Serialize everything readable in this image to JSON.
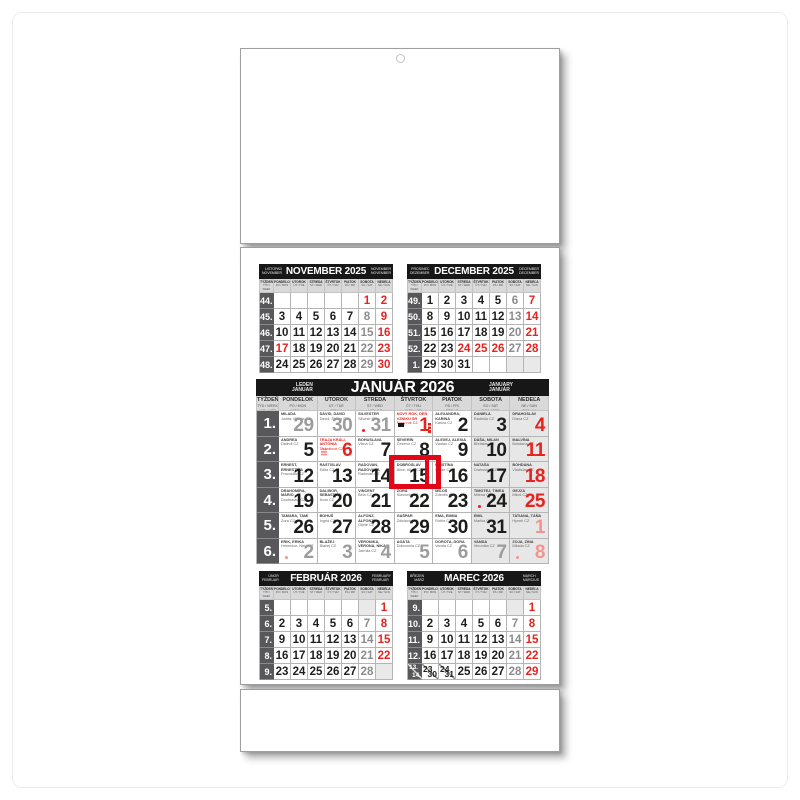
{
  "colors": {
    "red": "#e5231f",
    "cursor_red": "#e30617",
    "header_bar": "#171717",
    "week_col": "#58585a",
    "weekend_bg": "#e7e7e7",
    "saturday_num": "#8c8c8c",
    "muted_num": "#9c9c9c",
    "faded_red": "#f0958f"
  },
  "weekday_cols": [
    {
      "name": "TÝŽDEŇ",
      "sub1": "TÝD / WEEK",
      "sub2": "WO / HÉT"
    },
    {
      "name": "PONDELOK",
      "sub1": "PO / MON",
      "sub2": "MON / H"
    },
    {
      "name": "UTOROK",
      "sub1": "ÚT / TUE",
      "sub2": "DIE / K"
    },
    {
      "name": "STREDA",
      "sub1": "ST / WED",
      "sub2": "MIT / SZ"
    },
    {
      "name": "ŠTVRTOK",
      "sub1": "ČT / THU",
      "sub2": "DON / CS"
    },
    {
      "name": "PIATOK",
      "sub1": "PÁ / FRI",
      "sub2": "FRE / P"
    },
    {
      "name": "SOBOTA",
      "sub1": "SO / SAT",
      "sub2": "SAM / SZO"
    },
    {
      "name": "NEDEĽA",
      "sub1": "NE / SUN",
      "sub2": "SON / V"
    }
  ],
  "months": {
    "november": {
      "title": "NOVEMBER 2025",
      "left_top": "LISTOPAD",
      "left_bottom": "NOVEMBER",
      "right_top": "NOVEMBER",
      "right_bottom": "NOVEMBER",
      "weeks": [
        {
          "num": "44.",
          "days": [
            {},
            {},
            {},
            {},
            {},
            {
              "t": "1",
              "c": "hol"
            },
            {
              "t": "2",
              "c": "sun"
            }
          ]
        },
        {
          "num": "45.",
          "days": [
            {
              "t": "3"
            },
            {
              "t": "4"
            },
            {
              "t": "5"
            },
            {
              "t": "6"
            },
            {
              "t": "7"
            },
            {
              "t": "8",
              "c": "sat"
            },
            {
              "t": "9",
              "c": "sun"
            }
          ]
        },
        {
          "num": "46.",
          "days": [
            {
              "t": "10"
            },
            {
              "t": "11"
            },
            {
              "t": "12"
            },
            {
              "t": "13"
            },
            {
              "t": "14"
            },
            {
              "t": "15",
              "c": "sat"
            },
            {
              "t": "16",
              "c": "sun"
            }
          ]
        },
        {
          "num": "47.",
          "days": [
            {
              "t": "17",
              "c": "hol"
            },
            {
              "t": "18"
            },
            {
              "t": "19"
            },
            {
              "t": "20"
            },
            {
              "t": "21"
            },
            {
              "t": "22",
              "c": "sat"
            },
            {
              "t": "23",
              "c": "sun"
            }
          ]
        },
        {
          "num": "48.",
          "days": [
            {
              "t": "24"
            },
            {
              "t": "25"
            },
            {
              "t": "26"
            },
            {
              "t": "27"
            },
            {
              "t": "28"
            },
            {
              "t": "29",
              "c": "sat"
            },
            {
              "t": "30",
              "c": "sun"
            }
          ]
        }
      ]
    },
    "december": {
      "title": "DECEMBER 2025",
      "left_top": "PROSINEC",
      "left_bottom": "DEZEMBER",
      "right_top": "DECEMBER",
      "right_bottom": "DECEMBER",
      "weeks": [
        {
          "num": "49.",
          "days": [
            {
              "t": "1"
            },
            {
              "t": "2"
            },
            {
              "t": "3"
            },
            {
              "t": "4"
            },
            {
              "t": "5"
            },
            {
              "t": "6",
              "c": "sat"
            },
            {
              "t": "7",
              "c": "sun"
            }
          ]
        },
        {
          "num": "50.",
          "days": [
            {
              "t": "8"
            },
            {
              "t": "9"
            },
            {
              "t": "10"
            },
            {
              "t": "11"
            },
            {
              "t": "12"
            },
            {
              "t": "13",
              "c": "sat"
            },
            {
              "t": "14",
              "c": "sun"
            }
          ]
        },
        {
          "num": "51.",
          "days": [
            {
              "t": "15"
            },
            {
              "t": "16"
            },
            {
              "t": "17"
            },
            {
              "t": "18"
            },
            {
              "t": "19"
            },
            {
              "t": "20",
              "c": "sat"
            },
            {
              "t": "21",
              "c": "sun"
            }
          ]
        },
        {
          "num": "52.",
          "days": [
            {
              "t": "22"
            },
            {
              "t": "23"
            },
            {
              "t": "24",
              "c": "hol"
            },
            {
              "t": "25",
              "c": "hol"
            },
            {
              "t": "26",
              "c": "hol"
            },
            {
              "t": "27",
              "c": "sat"
            },
            {
              "t": "28",
              "c": "sun"
            }
          ]
        },
        {
          "num": "1.",
          "days": [
            {
              "t": "29"
            },
            {
              "t": "30"
            },
            {
              "t": "31"
            },
            {},
            {},
            {
              "c": "shade"
            },
            {
              "c": "shade"
            }
          ]
        }
      ]
    },
    "january": {
      "title": "JANUÁR 2026",
      "left_top": "LEDEN",
      "left_bottom": "JANUAR",
      "right_top": "JANUARY",
      "right_bottom": "JANUÁR",
      "weeks": [
        {
          "num": "1.",
          "days": [
            {
              "n": "29",
              "c": "prev",
              "name": "MILADA",
              "sub": "Judita, Milada CZ"
            },
            {
              "n": "30",
              "c": "prev",
              "name": "DÁVID, DAVID",
              "sub": "David, Šimon CZ"
            },
            {
              "n": "31",
              "c": "prev",
              "name": "SILVESTER",
              "sub": "Silvestr CZ",
              "marker": "dot"
            },
            {
              "n": "1",
              "c": "hol",
              "name": "NOVÝ ROK, DEŇ VZNIKU SR",
              "sub": "Nový rok CZ",
              "marker": "flagbar"
            },
            {
              "n": "2",
              "name": "ALEXANDRA, KARINA",
              "sub": "Karina CZ"
            },
            {
              "n": "3",
              "c": "sat",
              "name": "DANIELA",
              "sub": "Radmila CZ"
            },
            {
              "n": "4",
              "c": "sun",
              "name": "DRAHOSLAV",
              "sub": "Diana CZ"
            }
          ]
        },
        {
          "num": "2.",
          "days": [
            {
              "n": "5",
              "name": "ANDREA",
              "sub": "Dalimil CZ"
            },
            {
              "n": "6",
              "c": "hol",
              "name": "TRAJA KRÁLI, ANTÓNIA",
              "sub": "Tři králové CZ",
              "marker": "dots"
            },
            {
              "n": "7",
              "name": "BOHUSLAVA",
              "sub": "Vilma CZ"
            },
            {
              "n": "8",
              "name": "SEVERÍN",
              "sub": "Čestmír CZ"
            },
            {
              "n": "9",
              "name": "ALEXEJ, ALEXIA",
              "sub": "Vladan CZ"
            },
            {
              "n": "10",
              "c": "sat",
              "name": "DÁŠA, MILAN",
              "sub": "Břetislav CZ"
            },
            {
              "n": "11",
              "c": "sun",
              "name": "MALVÍNA",
              "sub": "Bohdana CZ"
            }
          ]
        },
        {
          "num": "3.",
          "days": [
            {
              "n": "12",
              "name": "ERNEST, ERNESTÍNA",
              "sub": "Pravoslav CZ"
            },
            {
              "n": "13",
              "name": "RASTISLAV",
              "sub": "Edita CZ"
            },
            {
              "n": "14",
              "name": "RADOVAN, RADOVANA",
              "sub": "Radovan CZ"
            },
            {
              "n": "15",
              "name": "DOBROSLAV",
              "sub": "Alice, Alica CZ"
            },
            {
              "n": "16",
              "name": "KRISTÍNA",
              "sub": "Ctirad CZ"
            },
            {
              "n": "17",
              "c": "sat",
              "name": "NATAŠA",
              "sub": "Drahoslav CZ"
            },
            {
              "n": "18",
              "c": "sun",
              "name": "BOHDANA",
              "sub": "Vladislav CZ"
            }
          ]
        },
        {
          "num": "4.",
          "days": [
            {
              "n": "19",
              "name": "DRAHOMÍRA, MÁRIO",
              "sub": "Doubravka CZ"
            },
            {
              "n": "20",
              "name": "DALIBOR, SEBASTIÁN",
              "sub": "Ilona CZ"
            },
            {
              "n": "21",
              "name": "VINCENT",
              "sub": "Běla CZ"
            },
            {
              "n": "22",
              "name": "ZORA",
              "sub": "Slavomír CZ"
            },
            {
              "n": "23",
              "name": "MILOŠ",
              "sub": "Zdeněk CZ"
            },
            {
              "n": "24",
              "c": "sat",
              "name": "TIMOTEJ, TIMEA",
              "sub": "Milena CZ",
              "marker": "dot"
            },
            {
              "n": "25",
              "c": "sun",
              "name": "GEJZA",
              "sub": "Miloš CZ"
            }
          ]
        },
        {
          "num": "5.",
          "days": [
            {
              "n": "26",
              "name": "TAMARA, TAMI",
              "sub": "Zora CZ"
            },
            {
              "n": "27",
              "name": "BOHUŠ",
              "sub": "Ingrid CZ"
            },
            {
              "n": "28",
              "name": "ALFONZ, ALFONZIA",
              "sub": "Otýlie CZ"
            },
            {
              "n": "29",
              "name": "GAŠPAR",
              "sub": "Zdislava CZ"
            },
            {
              "n": "30",
              "name": "EMA, EMMA",
              "sub": "Robin CZ"
            },
            {
              "n": "31",
              "c": "sat",
              "name": "EMIL",
              "sub": "Marika CZ"
            },
            {
              "n": "1",
              "c": "nextsun",
              "name": "TATIANA, TÁŇA",
              "sub": "Hynek CZ"
            }
          ]
        },
        {
          "num": "6.",
          "days": [
            {
              "n": "2",
              "c": "next",
              "name": "ERIK, ERIKA",
              "sub": "Hromnice, Nela CZ",
              "marker": "dot"
            },
            {
              "n": "3",
              "c": "next",
              "name": "BLAŽEJ",
              "sub": "Blažej CZ"
            },
            {
              "n": "4",
              "c": "next",
              "name": "VERONIKA, VERONA, NIKA",
              "sub": "Jarmila CZ"
            },
            {
              "n": "5",
              "c": "next",
              "name": "AGÁTA",
              "sub": "Dobromila CZ"
            },
            {
              "n": "6",
              "c": "next",
              "name": "DOROTA, DORA",
              "sub": "Vanda CZ"
            },
            {
              "n": "7",
              "c": "next",
              "name": "VANDA",
              "sub": "Veronika CZ"
            },
            {
              "n": "8",
              "c": "nextsun",
              "name": "ZOJA, ZINA",
              "sub": "Milada CZ",
              "marker": "dot"
            }
          ]
        }
      ]
    },
    "february": {
      "title": "FEBRUÁR 2026",
      "left_top": "ÚNOR",
      "left_bottom": "FEBRUAR",
      "right_top": "FEBRUARY",
      "right_bottom": "FEBRUÁR",
      "weeks": [
        {
          "num": "5.",
          "days": [
            {},
            {},
            {},
            {},
            {},
            {
              "c": "shade"
            },
            {
              "t": "1",
              "c": "sun"
            }
          ]
        },
        {
          "num": "6.",
          "days": [
            {
              "t": "2"
            },
            {
              "t": "3"
            },
            {
              "t": "4"
            },
            {
              "t": "5"
            },
            {
              "t": "6"
            },
            {
              "t": "7",
              "c": "sat"
            },
            {
              "t": "8",
              "c": "sun"
            }
          ]
        },
        {
          "num": "7.",
          "days": [
            {
              "t": "9"
            },
            {
              "t": "10"
            },
            {
              "t": "11"
            },
            {
              "t": "12"
            },
            {
              "t": "13"
            },
            {
              "t": "14",
              "c": "sat"
            },
            {
              "t": "15",
              "c": "sun"
            }
          ]
        },
        {
          "num": "8.",
          "days": [
            {
              "t": "16"
            },
            {
              "t": "17"
            },
            {
              "t": "18"
            },
            {
              "t": "19"
            },
            {
              "t": "20"
            },
            {
              "t": "21",
              "c": "sat"
            },
            {
              "t": "22",
              "c": "sun"
            }
          ]
        },
        {
          "num": "9.",
          "days": [
            {
              "t": "23"
            },
            {
              "t": "24"
            },
            {
              "t": "25"
            },
            {
              "t": "26"
            },
            {
              "t": "27"
            },
            {
              "t": "28",
              "c": "sat"
            },
            {
              "c": "shade"
            }
          ]
        }
      ]
    },
    "march": {
      "title": "MAREC 2026",
      "left_top": "BŘEZEN",
      "left_bottom": "MÄRZ",
      "right_top": "MARCH",
      "right_bottom": "MÁRCIUS",
      "weeks": [
        {
          "num": "9.",
          "days": [
            {},
            {},
            {},
            {},
            {},
            {
              "c": "shade"
            },
            {
              "t": "1",
              "c": "sun"
            }
          ]
        },
        {
          "num": "10.",
          "days": [
            {
              "t": "2"
            },
            {
              "t": "3"
            },
            {
              "t": "4"
            },
            {
              "t": "5"
            },
            {
              "t": "6"
            },
            {
              "t": "7",
              "c": "sat"
            },
            {
              "t": "8",
              "c": "sun"
            }
          ]
        },
        {
          "num": "11.",
          "days": [
            {
              "t": "9"
            },
            {
              "t": "10"
            },
            {
              "t": "11"
            },
            {
              "t": "12"
            },
            {
              "t": "13"
            },
            {
              "t": "14",
              "c": "sat"
            },
            {
              "t": "15",
              "c": "sun"
            }
          ]
        },
        {
          "num": "12.",
          "days": [
            {
              "t": "16"
            },
            {
              "t": "17"
            },
            {
              "t": "18"
            },
            {
              "t": "19"
            },
            {
              "t": "20"
            },
            {
              "t": "21",
              "c": "sat"
            },
            {
              "t": "22",
              "c": "sun"
            }
          ]
        },
        {
          "num": "13.",
          "num2": "14.",
          "days": [
            {
              "t": "23",
              "t2": "30"
            },
            {
              "t": "24",
              "t2": "31"
            },
            {
              "t": "25"
            },
            {
              "t": "26"
            },
            {
              "t": "27"
            },
            {
              "t": "28",
              "c": "sat"
            },
            {
              "t": "29",
              "c": "sun"
            }
          ]
        }
      ]
    }
  },
  "cursor": {
    "selected_day": "15"
  }
}
